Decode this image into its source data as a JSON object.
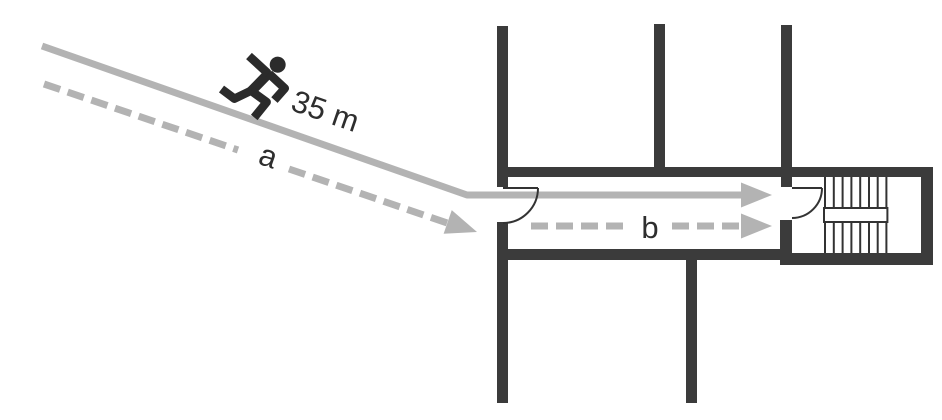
{
  "diagram": {
    "distance_label": "35 m",
    "route_a_label": "a",
    "route_b_label": "b",
    "icon": "running-person-icon"
  },
  "colors": {
    "route": "#b3b3b3",
    "wall": "#3b3b3b",
    "outline": "#333333",
    "text": "#2e2e2e",
    "figure": "#2b2b2b"
  }
}
